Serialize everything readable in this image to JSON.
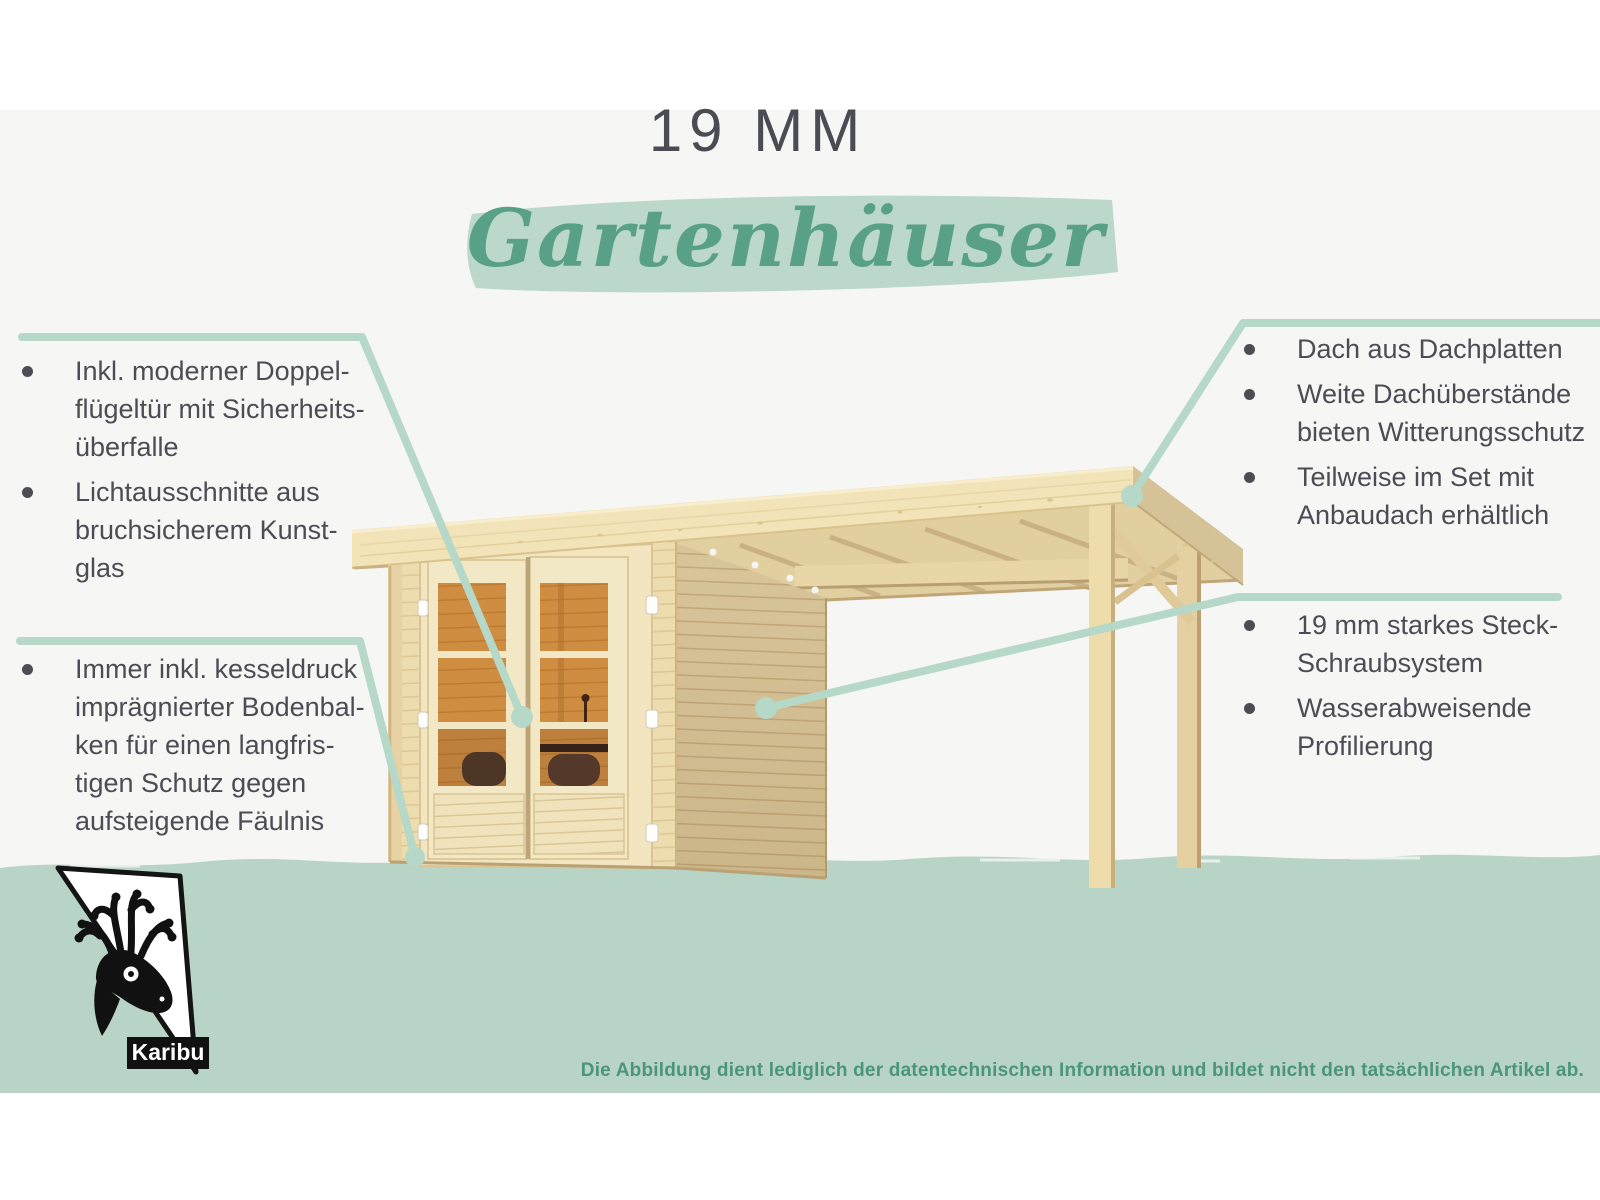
{
  "header": {
    "size_label": "19 MM",
    "category_label": "Gartenhäuser"
  },
  "callouts": {
    "left_top": {
      "items": [
        [
          "Inkl. moderner Doppel-",
          "flügeltür mit Sicherheits-",
          "überfalle"
        ],
        [
          "Lichtausschnitte aus",
          "bruchsicherem Kunst-",
          "glas"
        ]
      ]
    },
    "left_bottom": {
      "items": [
        [
          "Immer inkl. kesseldruck",
          "imprägnierter Bodenbal-",
          "ken für einen langfris-",
          "tigen Schutz gegen",
          "aufsteigende Fäulnis"
        ]
      ]
    },
    "right_top": {
      "items": [
        [
          "Dach aus Dachplatten"
        ],
        [
          "Weite Dachüberstände",
          "bieten Witterungsschutz"
        ],
        [
          "Teilweise im Set mit",
          "Anbaudach erhältlich"
        ]
      ]
    },
    "right_bottom": {
      "items": [
        [
          "19 mm starkes Steck-",
          "Schraubsystem"
        ],
        [
          "Wasserabweisende",
          "Profilierung"
        ]
      ]
    }
  },
  "footer": {
    "disclaimer": "Die Abbildung dient lediglich der datentechnischen Information und bildet nicht den tatsächlichen Artikel ab.",
    "logo_text": "Karibu"
  },
  "colors": {
    "accent_green": "#58a186",
    "sage_brush": "#bcd8ca",
    "sage_band": "#b8d4c6",
    "callout_line": "#b5d8c9",
    "text_dark": "#4b4b54",
    "footer_green": "#4b9579"
  }
}
